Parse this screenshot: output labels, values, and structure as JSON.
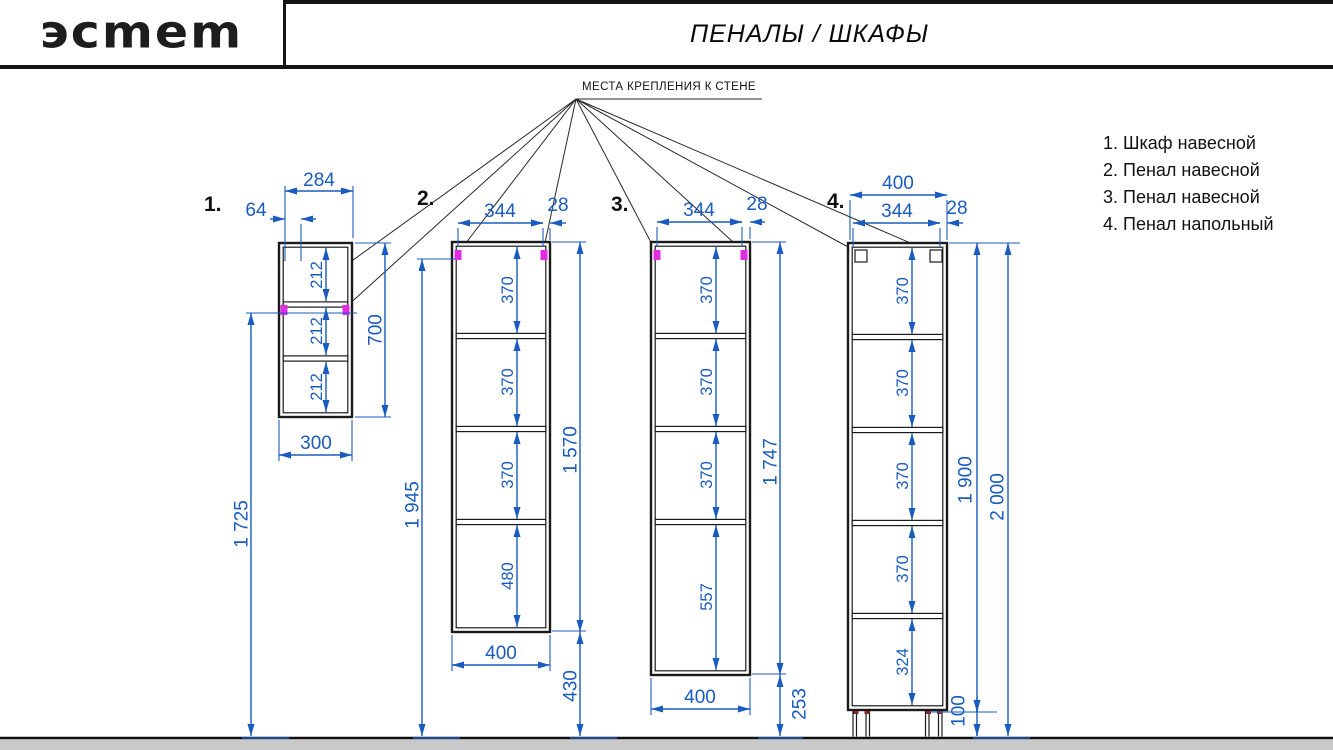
{
  "header": {
    "logo": "эсmеm",
    "title": "ПЕНАЛЫ / ШКАФЫ"
  },
  "wall_mount_note": "МЕСТА КРЕПЛЕНИЯ К СТЕНЕ",
  "legend": [
    "1. Шкаф навесной",
    "2. Пенал навесной",
    "3. Пенал навесной",
    "4. Пенал напольный"
  ],
  "colors": {
    "dimension_blue": "#1a5bbf",
    "mount_magenta": "#e22ce2",
    "line_black": "#1a1a1a",
    "floor_gray": "#c9c9c9"
  },
  "cabinets": [
    {
      "number": "1.",
      "dims": {
        "top_width": "284",
        "mount_offset": "64",
        "section_1": "212",
        "section_2": "212",
        "section_3": "212",
        "height": "700",
        "bottom_width": "300",
        "mount_height": "1 725"
      }
    },
    {
      "number": "2.",
      "dims": {
        "inner_width": "344",
        "wall": "28",
        "section_1": "370",
        "section_2": "370",
        "section_3": "370",
        "section_4": "480",
        "height": "1 570",
        "bottom_width": "400",
        "mount_height": "1 945",
        "floor_gap": "430"
      }
    },
    {
      "number": "3.",
      "dims": {
        "inner_width": "344",
        "wall": "28",
        "section_1": "370",
        "section_2": "370",
        "section_3": "370",
        "section_4": "557",
        "height": "1 747",
        "bottom_width": "400",
        "floor_gap": "253"
      }
    },
    {
      "number": "4.",
      "dims": {
        "width": "400",
        "inner_width": "344",
        "wall": "28",
        "section_1": "370",
        "section_2": "370",
        "section_3": "370",
        "section_4": "370",
        "section_5": "324",
        "height": "1 900",
        "total_height": "2 000",
        "leg_height": "100"
      }
    }
  ]
}
